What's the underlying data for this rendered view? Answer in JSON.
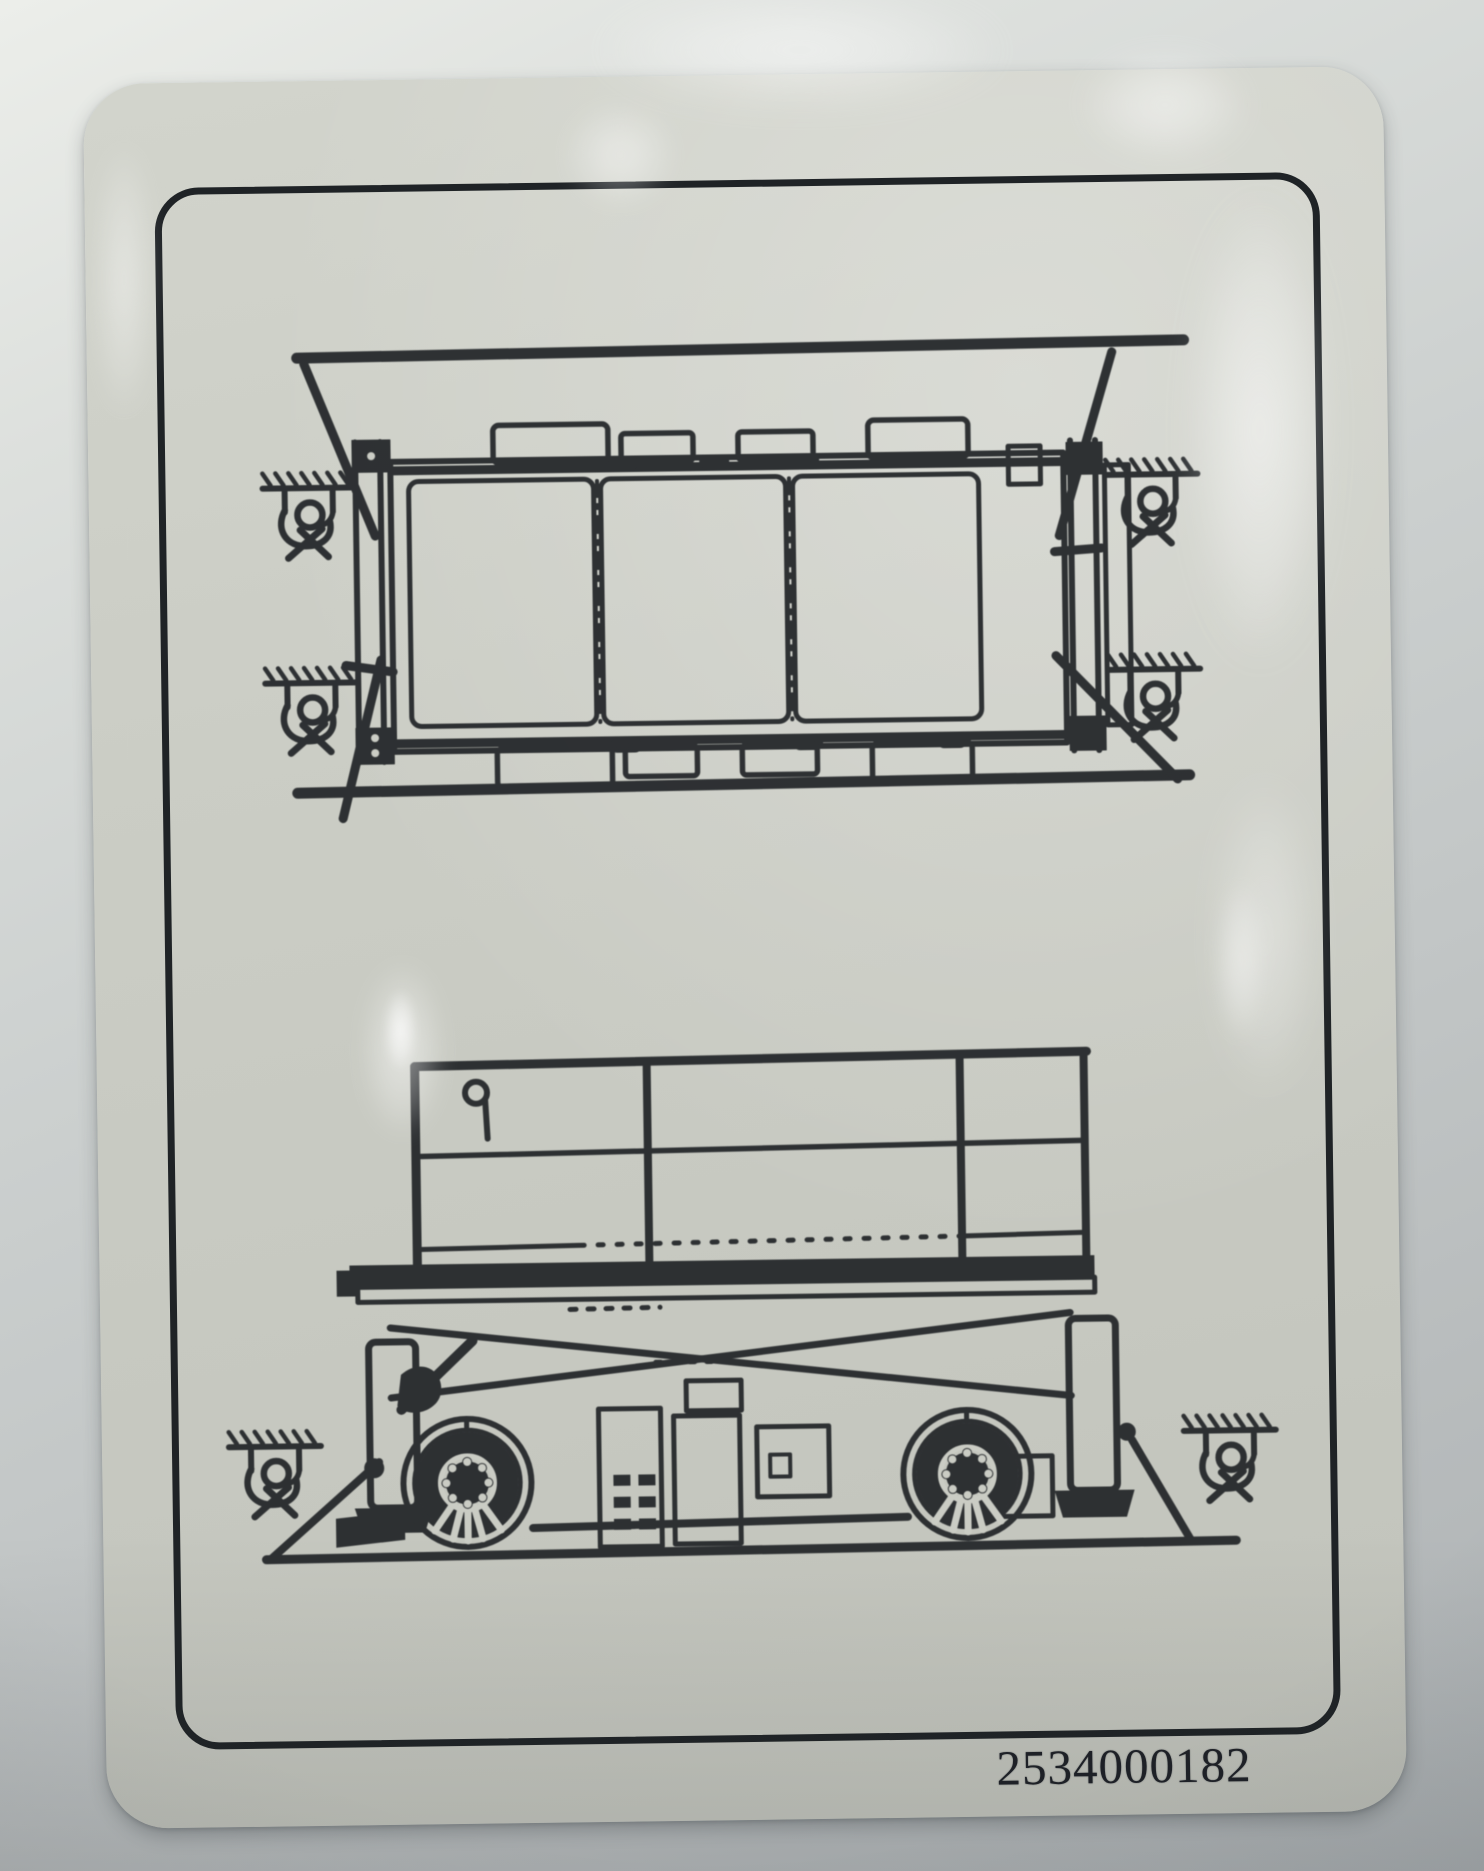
{
  "photo": {
    "desk_color": "#c6cac9",
    "sticker_color": "#cbcdc5",
    "ink_color": "#24272a",
    "border_color": "#1f2326"
  },
  "sticker": {
    "part_number": "2534000182",
    "top_view_name": "scissor-lift-plan-view-on-transport-deck",
    "side_view_name": "scissor-lift-side-view-on-transport-deck",
    "tie_down_symbol_name": "chain-anchor-tie-down-point-icon",
    "top_view_tie_down_count": 4,
    "side_view_tie_down_count": 2
  }
}
